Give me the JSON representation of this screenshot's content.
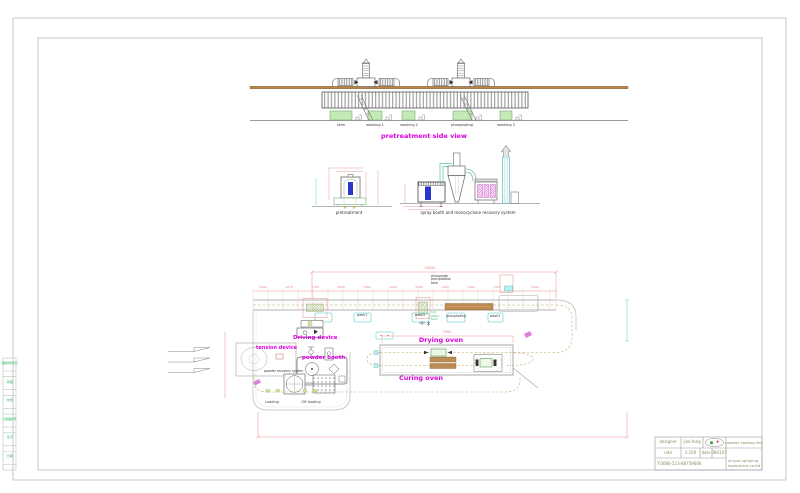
{
  "colors": {
    "magenta": "#dd00dd",
    "dim_red": "#e08a8a",
    "green_text": "#3dbb6a",
    "tan_beam": "#b5854b",
    "olive_chain": "#c2a86a",
    "cad_blue": "#2a35cc",
    "title_text": "#8b8b5e"
  },
  "side_strip": {
    "cells": [
      "借通用件登记",
      "审 图",
      "校 准",
      "旧底图总号",
      "签 字",
      "日 期"
    ]
  },
  "top_view": {
    "caption": "pretreatment side view",
    "tank_labels": [
      "skim",
      "washing 1",
      "washing 2",
      "phosphating",
      "washing 3"
    ]
  },
  "mid_view": {
    "left_caption": "pretreatment",
    "right_caption": "spray booth and monocyclone recovery system"
  },
  "plan_view": {
    "labels": {
      "tension_device": "tension device",
      "driving_device": "Driving device",
      "powder_booth": "powder booth",
      "powder_recovery": "powder recovery system",
      "drying_oven": "Drying oven",
      "curing_oven": "Curing oven",
      "loading": "Loading",
      "offloading": "Off-loading",
      "wash1": "wash1",
      "wash2": "wash2",
      "wash3": "wash3",
      "phosphating": "phosphating"
    },
    "phosphate_tank_lines": [
      "phosphate",
      "precipitation",
      "tank"
    ],
    "hot_water_tank_lines": [
      "hot",
      "water",
      "tank"
    ],
    "dims": {
      "overall_top": "24050",
      "oven_length": "7000",
      "chain": [
        "2500",
        "2275",
        "1700",
        "3000",
        "3450",
        "1000",
        "3445",
        "1400",
        "1000",
        "1700",
        "3200"
      ]
    }
  },
  "title_block": {
    "designer_label": "designer",
    "designer_value": "jiao feng",
    "rate_label": "rate",
    "rate_value": "1:100",
    "date_label": "date",
    "date_value": "080107",
    "phone": "T:0086-523-88759666",
    "project": "powder coating line",
    "company_line1": "xinyue spraying",
    "company_line2": "equipment co.ltd"
  }
}
